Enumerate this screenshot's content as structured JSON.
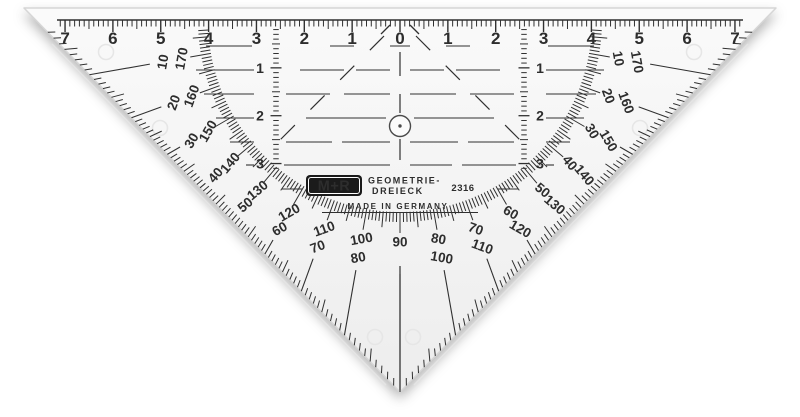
{
  "colors": {
    "ink": "#303030",
    "ink_soft": "#4a4a4a",
    "plastic_top": "#fafafa",
    "plastic_bottom": "#ededed",
    "edge": "#d6d6d6",
    "bevel": "#e4e4e4",
    "mold": "#e6e6e6",
    "logo_bg": "#1b1b1b",
    "logo_fg": "#ffffff"
  },
  "ruler": {
    "unit_labels": [
      "7",
      "6",
      "5",
      "4",
      "3",
      "2",
      "1",
      "0",
      "1",
      "2",
      "3",
      "4",
      "5",
      "6",
      "7"
    ]
  },
  "vertical_scales": {
    "labels": [
      "1",
      "2",
      "3"
    ]
  },
  "protractor": {
    "pairs": [
      {
        "angle": 10,
        "inner": "10",
        "outer": "170"
      },
      {
        "angle": 20,
        "inner": "20",
        "outer": "160"
      },
      {
        "angle": 30,
        "inner": "30",
        "outer": "150"
      },
      {
        "angle": 40,
        "inner": "40",
        "outer": "140"
      },
      {
        "angle": 50,
        "inner": "50",
        "outer": "130"
      },
      {
        "angle": 60,
        "inner": "60",
        "outer": "120"
      },
      {
        "angle": 70,
        "inner": "70",
        "outer": "110"
      },
      {
        "angle": 80,
        "inner": "80",
        "outer": "100"
      },
      {
        "angle": 90,
        "inner": "90",
        "outer": ""
      },
      {
        "angle": 100,
        "inner": "100",
        "outer": "80"
      },
      {
        "angle": 110,
        "inner": "110",
        "outer": "70"
      },
      {
        "angle": 120,
        "inner": "120",
        "outer": "60"
      },
      {
        "angle": 130,
        "inner": "130",
        "outer": "50"
      },
      {
        "angle": 140,
        "inner": "140",
        "outer": "40"
      },
      {
        "angle": 150,
        "inner": "150",
        "outer": "30"
      },
      {
        "angle": 160,
        "inner": "160",
        "outer": "20"
      },
      {
        "angle": 170,
        "inner": "170",
        "outer": "10"
      }
    ]
  },
  "logo": {
    "brand": "M+R",
    "product_line1": "GEOMETRIE-",
    "product_line2": "DREIECK",
    "model": "2316",
    "origin": "MADE IN GERMANY"
  }
}
